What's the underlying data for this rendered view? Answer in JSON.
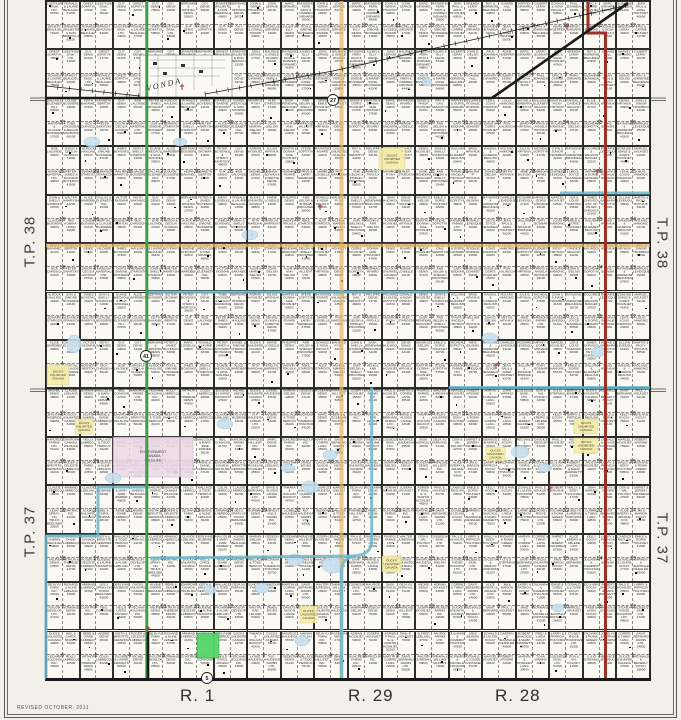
{
  "labels": {
    "tp38": "T.P. 38",
    "tp37": "T.P. 37",
    "r1": "R. 1",
    "r29": "R. 29",
    "r28": "R. 28",
    "revised": "REVISED  OCTOBER,  2011",
    "vonda": "VONDA"
  },
  "colors": {
    "green_route": "#3f9e45",
    "red_route": "#9e3125",
    "orange_route": "#e3b56a",
    "teal_route": "#6cb7cc",
    "yellow_parcel": "#f5eda9",
    "pink_parcel": "#ecd7e8",
    "green_parcel": "#55d76a",
    "pond": "#c9e0ef",
    "pond_edge": "#9abedb",
    "road": "#1a1a1a",
    "cross": "#9b3026",
    "paper": "#faf9f3"
  },
  "owners": {
    "north": {
      "west": [
        "101074108 SASK. LTD.",
        "JENNIFER WALMSTEN & DON BERZOLLA",
        "GUY DENIS",
        "RONALD & LAURIE BEAULIEU",
        "BERNARD & RHONDA DENIS",
        "OREST SOPATYK",
        "ERNEST BEAULIEU",
        "GUY DENIS"
      ],
      "center": [
        "JOHN & VERNA THURSTON",
        "JULIEN & ELLY DENIS",
        "RAYMOND FERN & DARREN GIRNARD",
        "JOHN LEPAGE",
        "DON & SIMONE BUSSIERE",
        "MARC GIRNARD",
        "MAURICE & GISELE RIVARD",
        "RAYMOND & MARIE-ROSE BUSSIERE",
        "RAYMOND FERN DION & DARREN GIRNARD",
        "MICHELLE GIRNARD"
      ],
      "east": [
        "HARVEY GIRNARD",
        "SUZANNE JEANNEAU",
        "LARRY BODNAR",
        "GILBERT LERAY",
        "JEAN PAUL & ANNA HOUNJET",
        "DONALD & NOVA PROULX",
        "JOHN D. GELSKI",
        "BRENDA LERAY",
        "PAUL JEANNEAU",
        "RAY & ADRIENNE BEAUREGARD",
        "ERIC & CARRIE HOUNJET",
        "ADAM HOEPPER",
        "JOANNE HILL",
        "MARC GIRNARD"
      ]
    },
    "tp38": {
      "west": [
        "KENNETH BERTON",
        "TUBB CROSSDALE & MEGAN MACDONALD",
        "GUY DENIS",
        "NICK CHRUSCH",
        "BERNARD & RHONDA DENIS",
        "BOB LALONDE",
        "PETER SAWITSKY",
        "PETER & JAMES BOYENKO",
        "JASON & CECILIA GUNSON",
        "MARC LOISELLE",
        "ALROCK HAULING",
        "HANSON MATERIALS LTD.",
        "RONALD & LAURIE BEAULIEU",
        "DON & SIMONE BUSSIERE",
        "PETER JAMES & RICHARD BOYENKO",
        "JAMES BOYENKO",
        "EDWARD STAROSTA",
        "DANIEL & SIMONE CHRUSCH",
        "JOHN & SHELLY STAROSTA",
        "ALEXANDRA GRANISCH",
        "DUANE WECKOLBORG & NINA SPANKEL",
        "WALTER HAWRYSHNIAK",
        "MICHAEL STAROSTA",
        "ALICE WARDBERG",
        "CLAUDE BUSSIERE",
        "BERTRAND BUSSIERE",
        "DALLAS & ELIZABETH HILL",
        "IRIS KOMINA-LINSKI",
        "VICTOR SKOMAR",
        "LOUISE BUSSIERE",
        "PETER BOYENKO & CHERYL MORTSON",
        "KEITH BAKANEC",
        "MARTIAL & CLAUDE BUSSIERE",
        "GUY DENIS"
      ],
      "center": [
        "DENNIS SLYWKA & LORETTE DENIS",
        "RAYMOND RIVARD",
        "NORMAN RIVARD",
        "EMILE & PHILIP HOUNJET",
        "DUCKS UNLIMITED CANADA",
        "STEVE & LARRY SEMBALERUS",
        "RAY & GAIL SEMCHYSHEN",
        "MARIE LOISELLE",
        "LAURENT LOISELLE",
        "PHILIPPE DENIS",
        "RITA MARCHAND",
        "RICHARD & LOUISE AMYOTTE",
        "ANN GELSKI & SHIRLEY PROCHERA",
        "EVELYN BARRINGTON",
        "DONALD & NOVA PROULX",
        "HARVEY PROULX",
        "DENIS HOUNJET",
        "MAURICE PYSH",
        "MIKE STAROSTA",
        "JOHN & SHELLY STAROSTA",
        "ALEX STAROSTA",
        "MICHAEL STAROSTA",
        "SASK. RENEWABLE RESOURCES",
        "ALVIN & MARIAN SIELSKI",
        "JOHN HUCHKOWSKI",
        "ANN SIELSKI & SHELLY PROCHERA",
        "JOHN SIELSKI",
        "DENIS EMILE HOUNJET",
        "ALVIN & ANN SIELSKI",
        "MAURICE SIELSKI",
        "ADRIAN HOUNJET",
        "PARADISE HILL ENT. LTD.",
        "EMILE & DORIS HOUNJET",
        "JULIUS HRYNIUK",
        "DONALD LAWLEY",
        "MARTIN & DONNA-MAE HOUNJET",
        "MICHEL DENIS",
        "MARC DENIS",
        "STEVE SOPOTYK"
      ],
      "east": [
        "RAYMOND & ADRIENNE BEAUREGARD",
        "HARMONIE FARMS LTD.",
        "DOLORES & WELDON BANGET",
        "CHARLES LEVESQUE",
        "DONALD LEVESQUE",
        "ROSAIRE LEVESQUE",
        "LEO & JOYCE JEANNEAU",
        "EDMOND EMILE & DORIS HOUNJET",
        "HARVEY & DORIS GIRNARD",
        "JEAN PAUL & ANNA HOUNJET",
        "MARCEL HOUNJET",
        "WILLIAM & ROSALIE BODNAR",
        "ANDRE & CARMELLA LAFRENIERE",
        "LEA & LOUIS HAMONIC",
        "GARY BODNAR",
        "JAMES CHRUSCH EST. OF PETER CHRUSCH",
        "LOUIS HAMONIC",
        "CHARLENE SCHMIDT",
        "WAYNE & BARBARA SOPOTYK",
        "EMILE & DORIS HOUNJET",
        "LILLIAN LEVESQUE",
        "WILLIAM & ELIZABETH REGUSH",
        "RON KALINOCHA",
        "MARTIN & RICKY HRYNIUK",
        "BRAD HRYNIUK",
        "MIKE P. HRYNIUK",
        "RANDAL & CANDICE REGUSH",
        "TRAVIS & ANGELA HRYNIUK",
        "ELSIE KALINOCHA",
        "ROLAND HAMONIC",
        "WILLIAM P. HRYNIUK",
        "JULIUS HRYNIUK",
        "JOHN D. SIELSKI",
        "DEREK HRYNIUK",
        "MICHEAL SOPOTYK",
        "NETTIE HRYNIUK",
        "JOHN & JUNIOR TROMBICKI",
        "MIKE BILINSKI",
        "JAMES & RHEA HRYNIUK"
      ]
    },
    "tp37": {
      "west": [
        "MALCOLM & MARY JANE ZIMMER",
        "DUCKS UNLIMITED CANADA",
        "NEIL CONACHER",
        "ALVINE SHERIN BEAULIEU",
        "NEIL & CAROL MOWAN",
        "HARDROCK FARMS LTD.",
        "RENE & DIANE LABRECQUE",
        "YECHAM HOLDINGS INC.",
        "ENVIRONMENT CANADA WILDLIFE",
        "ANDRE DENIS",
        "HOLLY LABRECQUE",
        "KEITH & BRIGITTE GERWING",
        "ARTHUR & THERESE DENIS",
        "WALLACE & TODD HEROUX",
        "ROGER & CELESTE LABRECQUE",
        "COLIN LABRECQUE",
        "DEJA VU FARM INC.",
        "EUGENE & LAURIE KRAWCHUK",
        "CLAUDE LABRECQUE",
        "RICHARD & ALINE LEBLANC",
        "MICHEL DENIS",
        "ARMAND LABRECQUE",
        "ROGOR DEVELOP. LTD.",
        "CLAUDE LEBLANC",
        "LES-2 SPRAY-ON TRUCK BEDLINER",
        "NORMAND DENIS",
        "JERLYNNE MCBRIDE",
        "CONTRACTING INC."
      ],
      "center": [
        "MAURICE HAUDEGAND",
        "LIONEL HAUDEGAND",
        "SASK. AGRICULTURE",
        "MARIAN SIELSKI",
        "M.F. HAUDEGAND FARMS LTD.",
        "DEJA VU FARM INC.",
        "GEDEON DENIS",
        "ANDRE DENIS",
        "ROSEANNE DENIS",
        "WALLACE & TODD HEROUX",
        "ADRIAN HOUNJET",
        "PARADISE HILL ENT. INC.",
        "JULIANNA & CAMERON THACHUK",
        "JOSEPH HOUNJET",
        "MARC DENIS",
        "ADRIEN P. PAUL E. & MARTIN HOUNJET",
        "SUNCREST FARMS INC.",
        "DENIS & ROSELINE HOUNJET",
        "PAUL E. HOUNJET",
        "WANZOURA INC.",
        "ALFRED LEBLANC",
        "MARTIN & CORRIE LANG",
        "KRISTAL RAE LELAND",
        "PAUROL FARMS LTD.",
        "SAINT BERNARD FARMS LTD.",
        "JAMES BOYES",
        "WALTER JURESHNISKI",
        "DAVID & ALISON LANGE",
        "DON & VAL POLISKY",
        "TAMARA & WILLIAM RACKOT",
        "NORMAND DENIS",
        "101080134 SASK. LTD.",
        "DUCKS UNLIMITED CANADA",
        "HARVEST HILLS FARMS INC."
      ],
      "east": [
        "CANDICE REGUSH",
        "JULIANNA & CAMERON THACHUK",
        "PAUL J. HOUNJET",
        "EMILE & DORIS HOUNJET",
        "MIKE BILINSKI",
        "KELLY KOCAY",
        "DONALD & LOUISE KOCAY",
        "NORMAND & MICHELLE FONTAINE",
        "ED & ANN KOCAY",
        "DARREN & JEANHALEA DENGLER",
        "DONALD & LOUISE FONTAINE",
        "ROBERT SHACKLETON & MARK MARGETTS",
        "MARCEL HOUNJET",
        "PAUL E. HOUNJET",
        "FRED & LINDA KOCAY",
        "ROBERT KRUSHE",
        "LARRY & PATRICIA HOLYNSKI",
        "MARVIN & CHARLENE LANG",
        "WALLY & EDDY HOLYNSKI",
        "STONEY RIDGE HOLDINGS LTD.",
        "JOHN WARING",
        "RICHARD & ROMA GREEN",
        "101155032 SASK. LTD.",
        "MARVIN & CORRIE LANG",
        "JOCELYN & MERVIN ZUROWSKI",
        "DON & VAL POLISKY",
        "CORRIE & TIMMY LANG",
        "G & D STEFANIUK",
        "JARRET & JEREMY VALDREUIL",
        "SAINT BERNARD FARMS LTD.",
        "BERNICE JENDRUCK",
        "ALICE KREPKI & ARLENE COX",
        "DUCKS UNLIMITED CANADA",
        "KELLY KOCAY",
        "JIM & MARION KOCAY",
        "REGINALD & BEVERLY KOCAY",
        "LARRY & PATRICIA KOCAY",
        "SAINT BERNARD"
      ]
    }
  },
  "values": [
    53700,
    37400,
    53800,
    50800,
    58500,
    61200,
    48700,
    47000,
    54200,
    54000,
    76100,
    79500,
    58100,
    70300,
    76200,
    62100,
    51200,
    84500,
    82100,
    82500,
    76800,
    75900,
    53000,
    47700,
    14000,
    31200,
    22900,
    49600,
    50900,
    57300,
    47500,
    59500,
    27000,
    59600,
    24000,
    40800,
    43600,
    69100,
    71800,
    65400,
    58700,
    55300,
    49800,
    46000,
    39700,
    57100,
    53300,
    48100,
    41500,
    43700,
    36400,
    33200,
    34000,
    17700,
    30900,
    41100,
    25300,
    33900,
    29400,
    40000,
    41900,
    54700,
    55800,
    30800,
    48600,
    34100,
    41800,
    36000,
    48000,
    47400,
    34800,
    24100,
    25700,
    35400,
    36900,
    37000,
    46300,
    32800,
    31800,
    36800,
    35800,
    23300,
    25800,
    42500,
    43000,
    27200,
    38300,
    34300,
    48800,
    42300,
    37600,
    44800,
    44600,
    43400,
    36300,
    38100,
    44400,
    49300,
    58000,
    52100,
    64500,
    54100,
    47200,
    54800,
    64800,
    62800,
    55000,
    57000,
    54600,
    41600,
    48300,
    39200,
    34700,
    50100,
    40300,
    42600,
    47800,
    50400,
    46200,
    31100,
    32600,
    28800,
    30300,
    47900,
    40600,
    53400,
    48200,
    43500,
    48900,
    38400,
    47600,
    27800,
    28100,
    34600,
    31700,
    45100,
    44700,
    42800,
    32100,
    31500,
    29100,
    38900,
    37100,
    40900,
    45600,
    32200,
    33400,
    26100,
    51000,
    52500,
    56200,
    45300,
    44100,
    36200,
    35600,
    25900,
    25100,
    42000,
    40500,
    45700,
    45900,
    56000,
    49400,
    45500,
    33000,
    42200,
    42900,
    52400,
    49100,
    57500,
    52600,
    41300,
    36100,
    43100,
    25500,
    35900,
    28700,
    50200,
    20700,
    52600,
    24400,
    51400,
    48500,
    42700,
    57900,
    41400,
    50500,
    48300,
    26500,
    25000,
    39100,
    44300,
    55700,
    43900,
    28500,
    34200,
    51900
  ],
  "map_features": {
    "shields": [
      {
        "x": 333,
        "y": 100,
        "t": "27"
      },
      {
        "x": 146,
        "y": 356,
        "t": "41"
      },
      {
        "x": 207,
        "y": 678,
        "t": "5"
      }
    ],
    "yellow_parcels": [
      {
        "x": 379,
        "y": 148,
        "w": 26,
        "h": 22
      },
      {
        "x": 47,
        "y": 365,
        "w": 22,
        "h": 20
      },
      {
        "x": 75,
        "y": 419,
        "w": 18,
        "h": 15
      },
      {
        "x": 574,
        "y": 419,
        "w": 24,
        "h": 15
      },
      {
        "x": 574,
        "y": 438,
        "w": 24,
        "h": 15
      },
      {
        "x": 486,
        "y": 447,
        "w": 19,
        "h": 14
      },
      {
        "x": 300,
        "y": 606,
        "w": 17,
        "h": 17
      },
      {
        "x": 382,
        "y": 556,
        "w": 19,
        "h": 16
      }
    ],
    "yellow_label": "DUCKS UNLIMITED CANADA",
    "pink_parcels": [
      {
        "x": 113,
        "y": 437,
        "w": 80,
        "h": 40
      }
    ],
    "pink_label": "ENVIRONMENT CANADA WILDLIFE",
    "green_parcels": [
      {
        "x": 197,
        "y": 633,
        "w": 22,
        "h": 25
      }
    ],
    "ponds": [
      [
        92,
        142,
        8,
        5
      ],
      [
        180,
        142,
        7,
        4
      ],
      [
        250,
        235,
        8,
        5
      ],
      [
        310,
        487,
        9,
        6
      ],
      [
        330,
        455,
        7,
        5
      ],
      [
        288,
        468,
        7,
        4
      ],
      [
        225,
        424,
        8,
        5
      ],
      [
        262,
        588,
        7,
        5
      ],
      [
        333,
        565,
        11,
        8
      ],
      [
        490,
        338,
        8,
        5
      ],
      [
        520,
        452,
        9,
        6
      ],
      [
        545,
        468,
        7,
        4
      ],
      [
        302,
        641,
        7,
        5
      ],
      [
        113,
        478,
        8,
        5
      ],
      [
        74,
        344,
        7,
        9
      ],
      [
        598,
        352,
        7,
        5
      ],
      [
        210,
        590,
        6,
        4
      ],
      [
        427,
        82,
        5,
        4
      ],
      [
        295,
        560,
        8,
        6
      ],
      [
        558,
        608,
        6,
        4
      ]
    ],
    "crosses": [
      [
        182,
        87
      ],
      [
        567,
        27
      ],
      [
        597,
        172
      ],
      [
        496,
        366
      ],
      [
        550,
        489
      ],
      [
        148,
        629
      ],
      [
        320,
        207
      ]
    ]
  }
}
